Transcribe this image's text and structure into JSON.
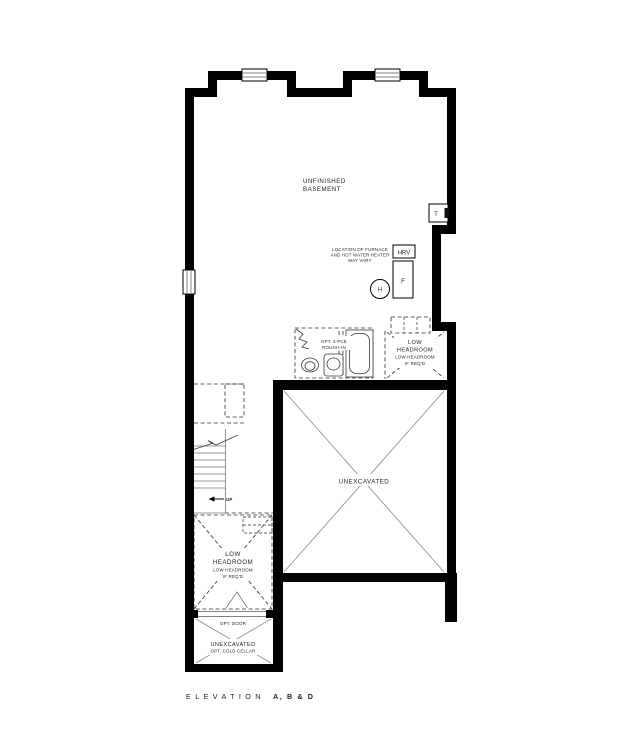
{
  "colors": {
    "wall": "#000000",
    "thin_line": "#3a3a3a",
    "gray_line": "#777777",
    "diagonal_line": "#8a8a8a",
    "text": "#1f1f1f",
    "background": "#ffffff"
  },
  "plan": {
    "basement": {
      "l1": "UNFINISHED",
      "l2": "BASEMENT"
    },
    "furnace_note": {
      "l1": "LOCATION OF FURNACE",
      "l2": "AND HOT WATER HEATER",
      "l3": "MAY VARY"
    },
    "equipment": {
      "hrv": "HRV",
      "furnace": "F",
      "hot_water": "H",
      "thermostat": "T"
    },
    "rough_in": {
      "l1": "OPT. 3-PCE",
      "l2": "ROUGH-IN"
    },
    "low_headroom_right": {
      "l1": "LOW",
      "l2": "HEADROOM",
      "l3": "LOW HEADROOM",
      "l4": "IF REQ'D"
    },
    "low_headroom_left": {
      "l1": "LOW",
      "l2": "HEADROOM",
      "l3": "LOW HEADROOM",
      "l4": "IF REQ'D"
    },
    "unexcavated": {
      "label": "UNEXCAVATED"
    },
    "stairs": {
      "up": "UP"
    },
    "opt_door": {
      "label": "OPT. DOOR"
    },
    "cold_cellar": {
      "l1": "UNEXCAVATED",
      "l2": "OPT. COLD CELLAR"
    }
  },
  "footer": {
    "elevation": "ELEVATION",
    "variants": "A, B & D"
  }
}
